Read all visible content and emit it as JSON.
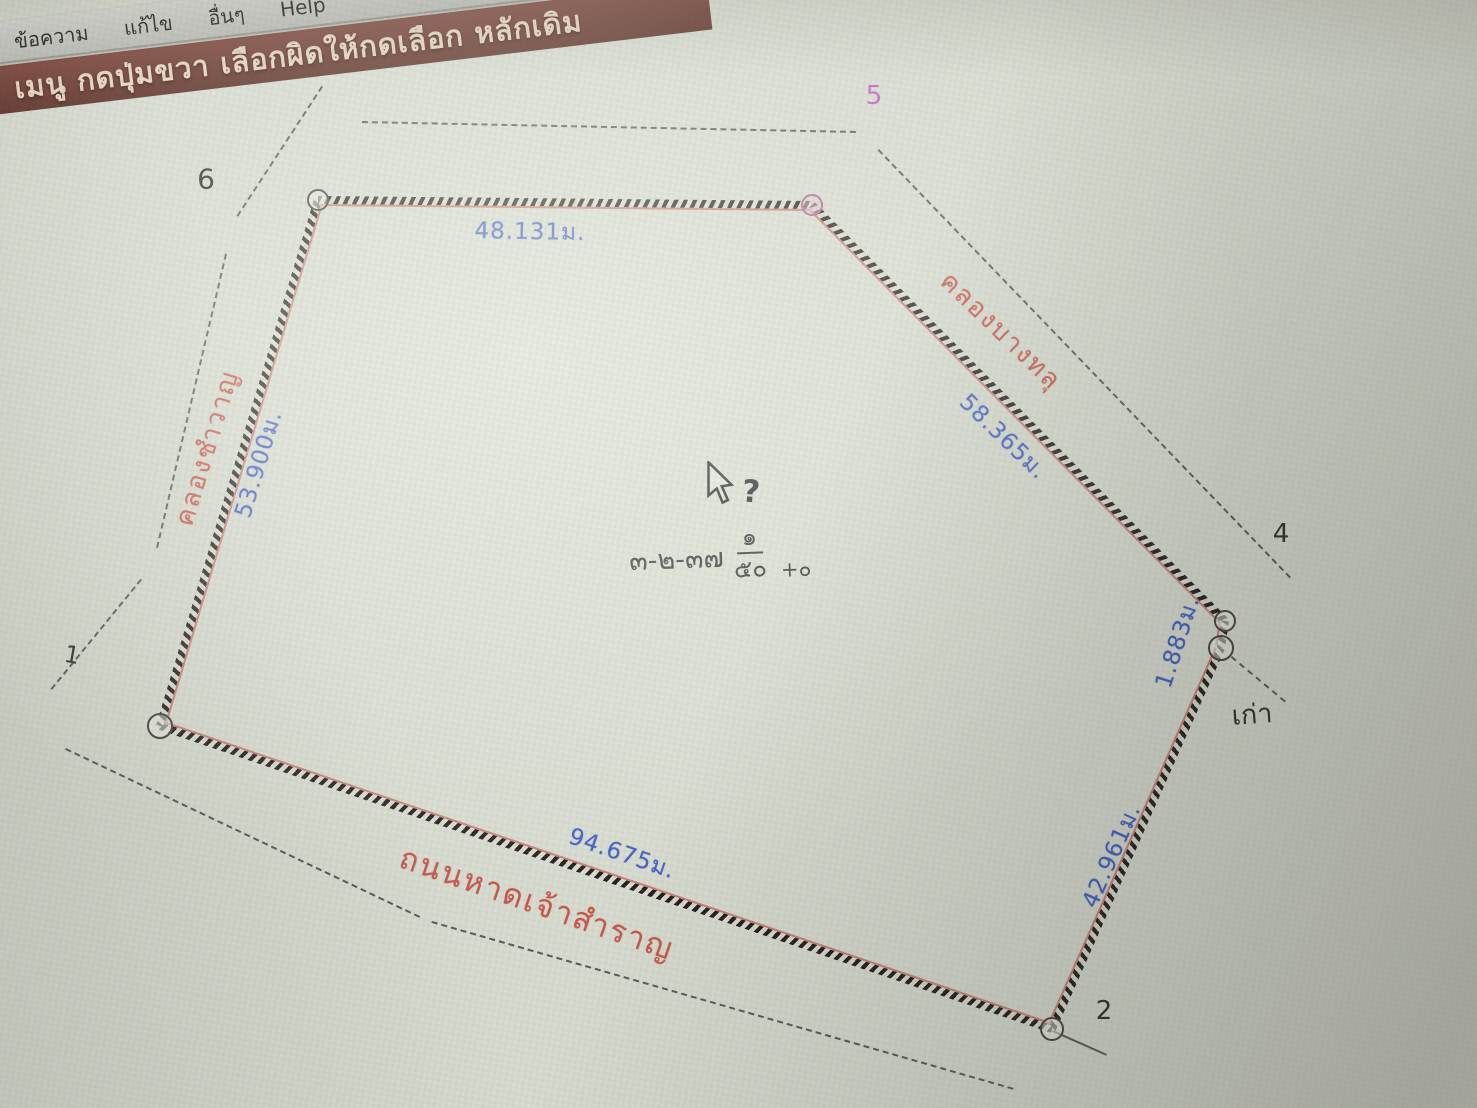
{
  "window": {
    "menu_items": [
      "ข้อความ",
      "แก้ไข",
      "อื่นๆ",
      "Help"
    ],
    "title_bar_text": "เมนู กดปุ่มขวา เลือกผิดให้กดเลือก หลักเดิม"
  },
  "colors": {
    "dimension_blue": "#3f5ec4",
    "name_red": "#c8564c",
    "vertex5_magenta": "#c75fc3",
    "titlebar_maroon": "#6e352b",
    "menubar_grey": "#c6c6c2"
  },
  "map": {
    "vertices": [
      {
        "x": 318,
        "y": 200,
        "r": 11,
        "pink": false
      },
      {
        "x": 812,
        "y": 205,
        "r": 11,
        "pink": true
      },
      {
        "x": 1225,
        "y": 621,
        "r": 11,
        "pink": false
      },
      {
        "x": 1221,
        "y": 648,
        "r": 13,
        "pink": false
      },
      {
        "x": 1052,
        "y": 1029,
        "r": 12,
        "pink": false
      },
      {
        "x": 160,
        "y": 726,
        "r": 13,
        "pink": false
      }
    ],
    "edges": [
      {
        "from": [
          318,
          200
        ],
        "to": [
          812,
          205
        ]
      },
      {
        "from": [
          812,
          205
        ],
        "to": [
          1225,
          621
        ]
      },
      {
        "from": [
          1225,
          621
        ],
        "to": [
          1221,
          648
        ]
      },
      {
        "from": [
          1221,
          648
        ],
        "to": [
          1052,
          1029
        ]
      },
      {
        "from": [
          1052,
          1029
        ],
        "to": [
          160,
          726
        ]
      },
      {
        "from": [
          160,
          726
        ],
        "to": [
          318,
          200
        ]
      }
    ],
    "edge_labels": [
      {
        "text": "48.131ม.",
        "x": 530,
        "y": 232,
        "rot": 1
      },
      {
        "text": "58.365ม.",
        "x": 1003,
        "y": 437,
        "rot": 44
      },
      {
        "text": "1.883ม.",
        "x": 1178,
        "y": 642,
        "rot": -72
      },
      {
        "text": "42.961ม.",
        "x": 1112,
        "y": 856,
        "rot": -66
      },
      {
        "text": "94.675ม.",
        "x": 622,
        "y": 854,
        "rot": 19
      },
      {
        "text": "53.900ม.",
        "x": 259,
        "y": 464,
        "rot": -73
      }
    ],
    "name_labels": [
      {
        "text": "คลองชำวาญ",
        "x": 207,
        "y": 448,
        "rot": -73,
        "size": 26
      },
      {
        "text": "คลองบางทลุ",
        "x": 1001,
        "y": 331,
        "rot": 44,
        "size": 26
      },
      {
        "text": "ถนนหาดเจ้าสำราญ",
        "x": 537,
        "y": 903,
        "rot": 19,
        "size": 31
      }
    ],
    "point_labels": [
      {
        "text": "1",
        "x": 72,
        "y": 655,
        "color": "#2b2b2b",
        "size": 24,
        "rot": 10
      },
      {
        "text": "2",
        "x": 1104,
        "y": 1011,
        "color": "#2b2b2b",
        "size": 26,
        "rot": 0
      },
      {
        "text": "4",
        "x": 1281,
        "y": 534,
        "color": "#2b2b2b",
        "size": 26,
        "rot": 0
      },
      {
        "text": "5",
        "x": 874,
        "y": 96,
        "color": "#c75fc3",
        "size": 26,
        "rot": 0
      },
      {
        "text": "6",
        "x": 206,
        "y": 179,
        "color": "#2b2b2b",
        "size": 28,
        "rot": 0
      },
      {
        "text": "เก่า",
        "x": 1252,
        "y": 714,
        "color": "#26262b",
        "size": 27,
        "rot": -4
      }
    ],
    "dashed_lines": [
      {
        "x1": 323,
        "y1": 87,
        "x2": 238,
        "y2": 217
      },
      {
        "x1": 227,
        "y1": 254,
        "x2": 158,
        "y2": 548
      },
      {
        "x1": 142,
        "y1": 580,
        "x2": 52,
        "y2": 690
      },
      {
        "x1": 66,
        "y1": 748,
        "x2": 420,
        "y2": 916
      },
      {
        "x1": 432,
        "y1": 921,
        "x2": 1014,
        "y2": 1088
      },
      {
        "x1": 362,
        "y1": 121,
        "x2": 856,
        "y2": 131
      },
      {
        "x1": 879,
        "y1": 149,
        "x2": 1291,
        "y2": 577
      },
      {
        "x1": 1232,
        "y1": 656,
        "x2": 1286,
        "y2": 701
      }
    ],
    "solid_lines": [
      {
        "x1": 1053,
        "y1": 1030,
        "x2": 1107,
        "y2": 1054
      }
    ],
    "area_label": {
      "prefix": "๓-๒-๓๗",
      "frac_num": "๑",
      "frac_den": "๕๐",
      "extra": "+๐",
      "x": 718,
      "y": 557
    },
    "cursor": {
      "x": 703,
      "y": 461,
      "question_x": 742,
      "question_y": 474,
      "question_mark": "?"
    }
  }
}
